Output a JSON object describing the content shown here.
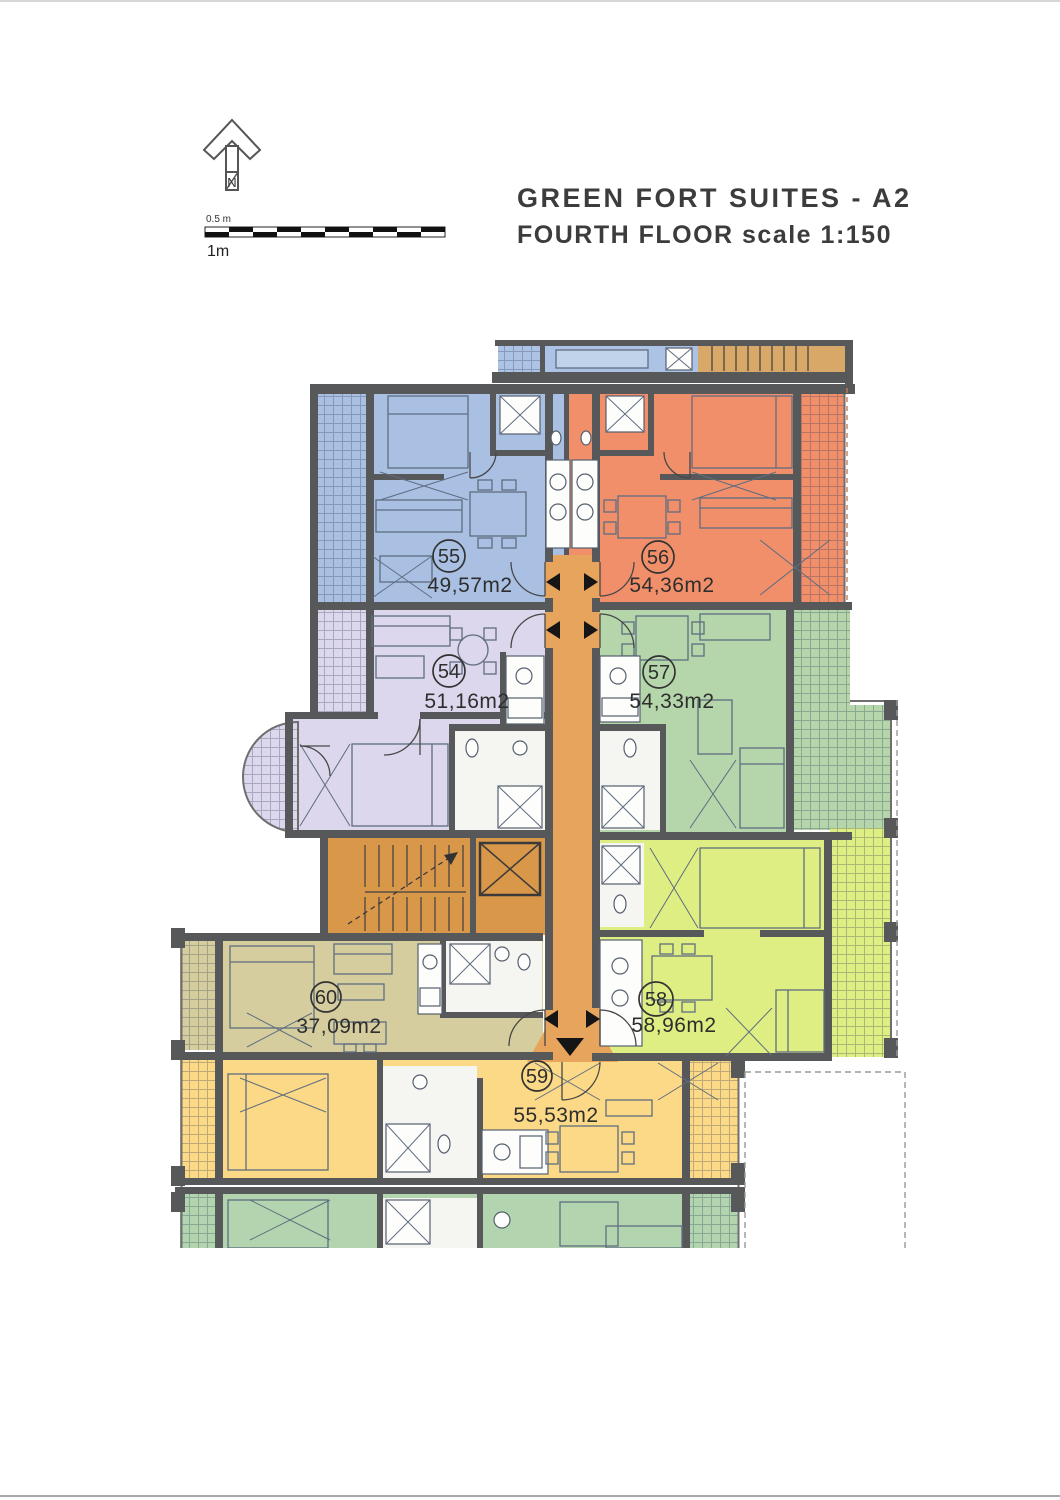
{
  "header": {
    "title_line1": "GREEN FORT SUITES - A2",
    "title_line2": "FOURTH FLOOR scale 1:150"
  },
  "compass": {
    "north_label": "N"
  },
  "scale_bar": {
    "half_meter_label": "0.5 m",
    "one_meter_label": "1m"
  },
  "plan": {
    "wall_color": "#57585a",
    "corridor_color": "#e7a45c",
    "stair_area_color": "#d9974a",
    "upper_floor_blue": "#adc3e5",
    "upper_floor_tan": "#d8a868",
    "adjacent_unit_color": "#b2d5b0",
    "units": [
      {
        "number": "54",
        "area": "51,16m2",
        "color": "#dcd7ec"
      },
      {
        "number": "55",
        "area": "49,57m2",
        "color": "#a9c0e3"
      },
      {
        "number": "56",
        "area": "54,36m2",
        "color": "#f28f6b"
      },
      {
        "number": "57",
        "area": "54,33m2",
        "color": "#b5d6ab"
      },
      {
        "number": "58",
        "area": "58,96m2",
        "color": "#dfee83"
      },
      {
        "number": "59",
        "area": "55,53m2",
        "color": "#fcd987"
      },
      {
        "number": "60",
        "area": "37,09m2",
        "color": "#d5cd9e"
      }
    ]
  }
}
